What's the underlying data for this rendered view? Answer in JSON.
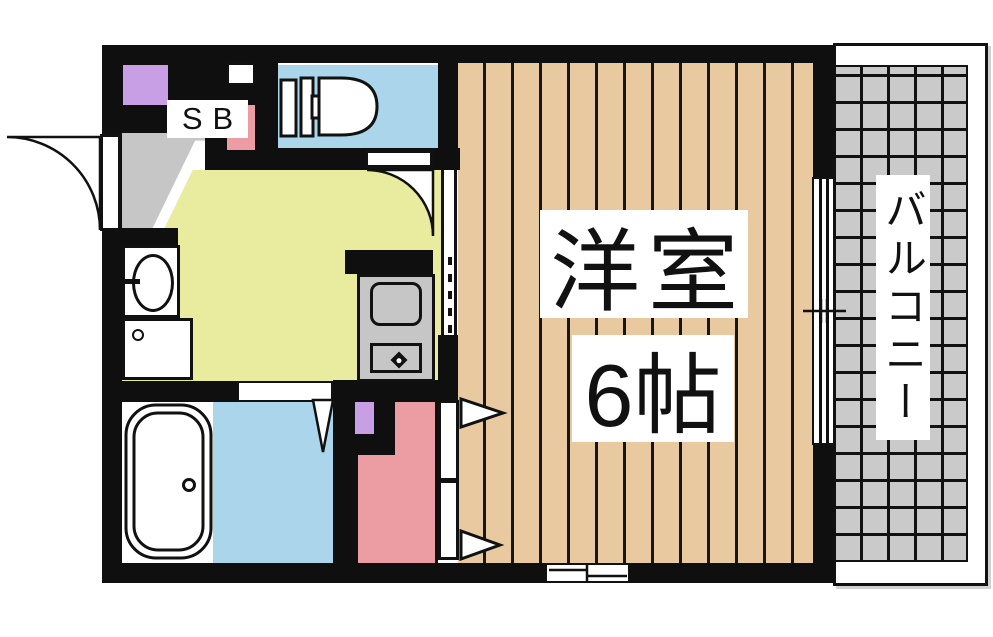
{
  "floorplan": {
    "labels": {
      "shoe_box": "SB",
      "main_room_name": "洋室",
      "main_room_size": "6帖",
      "balcony": "バルコニー"
    },
    "colors": {
      "wall": "#0f0f0f",
      "wood": "#e9caa0",
      "kitchen": "#e9eb9e",
      "water": "#aad5ea",
      "pink": "#ec9da4",
      "purple": "#c89fe5",
      "gray": "#c6c6c6",
      "tile": "#cacaca"
    }
  }
}
